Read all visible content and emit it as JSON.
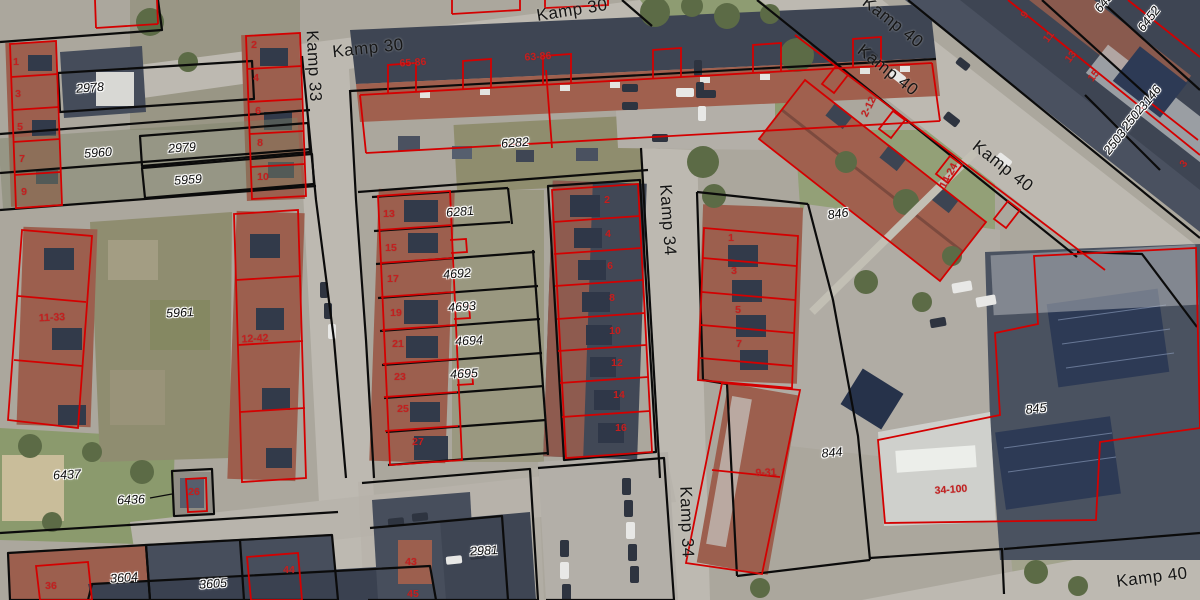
{
  "map": {
    "title": "Aerial cadastral view - Kamp neighbourhood",
    "colors": {
      "parcel_boundary": "#0b0b0b",
      "building_outline": "#d40000",
      "parcel_label": "#0d0d0d",
      "house_number": "#c41f1f",
      "street_label": "#161616"
    },
    "labels": {
      "streets": [
        {
          "text": "Kamp 30",
          "x": 368,
          "y": 48,
          "rot": -6
        },
        {
          "text": "Kamp 30",
          "x": 572,
          "y": 10,
          "rot": -9
        },
        {
          "text": "Kamp 33",
          "x": 314,
          "y": 66,
          "rot": 87
        },
        {
          "text": "Kamp 34",
          "x": 668,
          "y": 220,
          "rot": 86
        },
        {
          "text": "Kamp 34",
          "x": 687,
          "y": 522,
          "rot": 88
        },
        {
          "text": "Kamp 40",
          "x": 893,
          "y": 22,
          "rot": 38
        },
        {
          "text": "Kamp 40",
          "x": 888,
          "y": 70,
          "rot": 38
        },
        {
          "text": "Kamp 40",
          "x": 1003,
          "y": 166,
          "rot": 38
        },
        {
          "text": "Kamp 40",
          "x": 1152,
          "y": 577,
          "rot": -7
        }
      ],
      "parcels": [
        {
          "text": "2978",
          "x": 90,
          "y": 88,
          "rot": -4
        },
        {
          "text": "5960",
          "x": 98,
          "y": 153,
          "rot": -4
        },
        {
          "text": "2979",
          "x": 182,
          "y": 148,
          "rot": -4
        },
        {
          "text": "5959",
          "x": 188,
          "y": 180,
          "rot": -4
        },
        {
          "text": "5961",
          "x": 180,
          "y": 313,
          "rot": -3
        },
        {
          "text": "6437",
          "x": 67,
          "y": 475,
          "rot": -3
        },
        {
          "text": "6436",
          "x": 131,
          "y": 500,
          "rot": -2
        },
        {
          "text": "3604",
          "x": 124,
          "y": 578,
          "rot": -4
        },
        {
          "text": "3605",
          "x": 213,
          "y": 584,
          "rot": -4
        },
        {
          "text": "6282",
          "x": 515,
          "y": 143,
          "rot": -4
        },
        {
          "text": "6281",
          "x": 460,
          "y": 212,
          "rot": -4
        },
        {
          "text": "4692",
          "x": 457,
          "y": 274,
          "rot": -4
        },
        {
          "text": "4693",
          "x": 462,
          "y": 307,
          "rot": -4
        },
        {
          "text": "4694",
          "x": 469,
          "y": 341,
          "rot": -3
        },
        {
          "text": "4695",
          "x": 464,
          "y": 374,
          "rot": -3
        },
        {
          "text": "2981",
          "x": 484,
          "y": 551,
          "rot": -3
        },
        {
          "text": "846",
          "x": 838,
          "y": 214,
          "rot": -8
        },
        {
          "text": "845",
          "x": 1036,
          "y": 409,
          "rot": -6
        },
        {
          "text": "844",
          "x": 832,
          "y": 453,
          "rot": -5
        },
        {
          "text": "3146",
          "x": 1150,
          "y": 98,
          "rot": -52
        },
        {
          "text": "2502",
          "x": 1133,
          "y": 118,
          "rot": -52
        },
        {
          "text": "2503",
          "x": 1115,
          "y": 142,
          "rot": -52
        },
        {
          "text": "6452",
          "x": 1149,
          "y": 19,
          "rot": -52
        },
        {
          "text": "6452",
          "x": 1106,
          "y": 0,
          "rot": -52
        }
      ],
      "house_numbers": [
        {
          "text": "1",
          "x": 16,
          "y": 62,
          "rot": 0
        },
        {
          "text": "3",
          "x": 18,
          "y": 94,
          "rot": 0
        },
        {
          "text": "5",
          "x": 20,
          "y": 127,
          "rot": 0
        },
        {
          "text": "7",
          "x": 22,
          "y": 159,
          "rot": 0
        },
        {
          "text": "9",
          "x": 24,
          "y": 192,
          "rot": 0
        },
        {
          "text": "2",
          "x": 254,
          "y": 45,
          "rot": 0
        },
        {
          "text": "4",
          "x": 256,
          "y": 78,
          "rot": 0
        },
        {
          "text": "6",
          "x": 258,
          "y": 111,
          "rot": 0
        },
        {
          "text": "8",
          "x": 260,
          "y": 143,
          "rot": 0
        },
        {
          "text": "10",
          "x": 263,
          "y": 177,
          "rot": 0
        },
        {
          "text": "11-33",
          "x": 52,
          "y": 318,
          "rot": -3
        },
        {
          "text": "12-42",
          "x": 255,
          "y": 339,
          "rot": -3
        },
        {
          "text": "13",
          "x": 389,
          "y": 214,
          "rot": 0
        },
        {
          "text": "15",
          "x": 391,
          "y": 248,
          "rot": 0
        },
        {
          "text": "17",
          "x": 393,
          "y": 279,
          "rot": 0
        },
        {
          "text": "19",
          "x": 396,
          "y": 313,
          "rot": 0
        },
        {
          "text": "21",
          "x": 398,
          "y": 344,
          "rot": 0
        },
        {
          "text": "23",
          "x": 400,
          "y": 377,
          "rot": 0
        },
        {
          "text": "25",
          "x": 403,
          "y": 409,
          "rot": 0
        },
        {
          "text": "27",
          "x": 418,
          "y": 442,
          "rot": 0
        },
        {
          "text": "2",
          "x": 607,
          "y": 200,
          "rot": 0
        },
        {
          "text": "4",
          "x": 608,
          "y": 234,
          "rot": 0
        },
        {
          "text": "6",
          "x": 610,
          "y": 266,
          "rot": 0
        },
        {
          "text": "8",
          "x": 612,
          "y": 298,
          "rot": 0
        },
        {
          "text": "10",
          "x": 615,
          "y": 331,
          "rot": 0
        },
        {
          "text": "12",
          "x": 617,
          "y": 363,
          "rot": 0
        },
        {
          "text": "14",
          "x": 619,
          "y": 395,
          "rot": 0
        },
        {
          "text": "16",
          "x": 621,
          "y": 428,
          "rot": 0
        },
        {
          "text": "1",
          "x": 731,
          "y": 238,
          "rot": 0
        },
        {
          "text": "3",
          "x": 734,
          "y": 271,
          "rot": 0
        },
        {
          "text": "5",
          "x": 738,
          "y": 310,
          "rot": 0
        },
        {
          "text": "7",
          "x": 739,
          "y": 344,
          "rot": 0
        },
        {
          "text": "9-31",
          "x": 766,
          "y": 473,
          "rot": -2
        },
        {
          "text": "36",
          "x": 51,
          "y": 586,
          "rot": 0
        },
        {
          "text": "44",
          "x": 289,
          "y": 570,
          "rot": 0
        },
        {
          "text": "26",
          "x": 194,
          "y": 492,
          "rot": 0
        },
        {
          "text": "43",
          "x": 411,
          "y": 562,
          "rot": 0
        },
        {
          "text": "45",
          "x": 413,
          "y": 594,
          "rot": 0
        },
        {
          "text": "65-86",
          "x": 413,
          "y": 63,
          "rot": -4
        },
        {
          "text": "63-86",
          "x": 538,
          "y": 57,
          "rot": -4
        },
        {
          "text": "2-12",
          "x": 869,
          "y": 107,
          "rot": -64
        },
        {
          "text": "14-24",
          "x": 949,
          "y": 176,
          "rot": -62
        },
        {
          "text": "34-100",
          "x": 951,
          "y": 490,
          "rot": -4
        },
        {
          "text": "9",
          "x": 1025,
          "y": 15,
          "rot": -52
        },
        {
          "text": "11",
          "x": 1049,
          "y": 37,
          "rot": -52
        },
        {
          "text": "13",
          "x": 1071,
          "y": 57,
          "rot": -52
        },
        {
          "text": "15",
          "x": 1094,
          "y": 76,
          "rot": -52
        },
        {
          "text": "3",
          "x": 1184,
          "y": 164,
          "rot": -52
        }
      ]
    }
  }
}
